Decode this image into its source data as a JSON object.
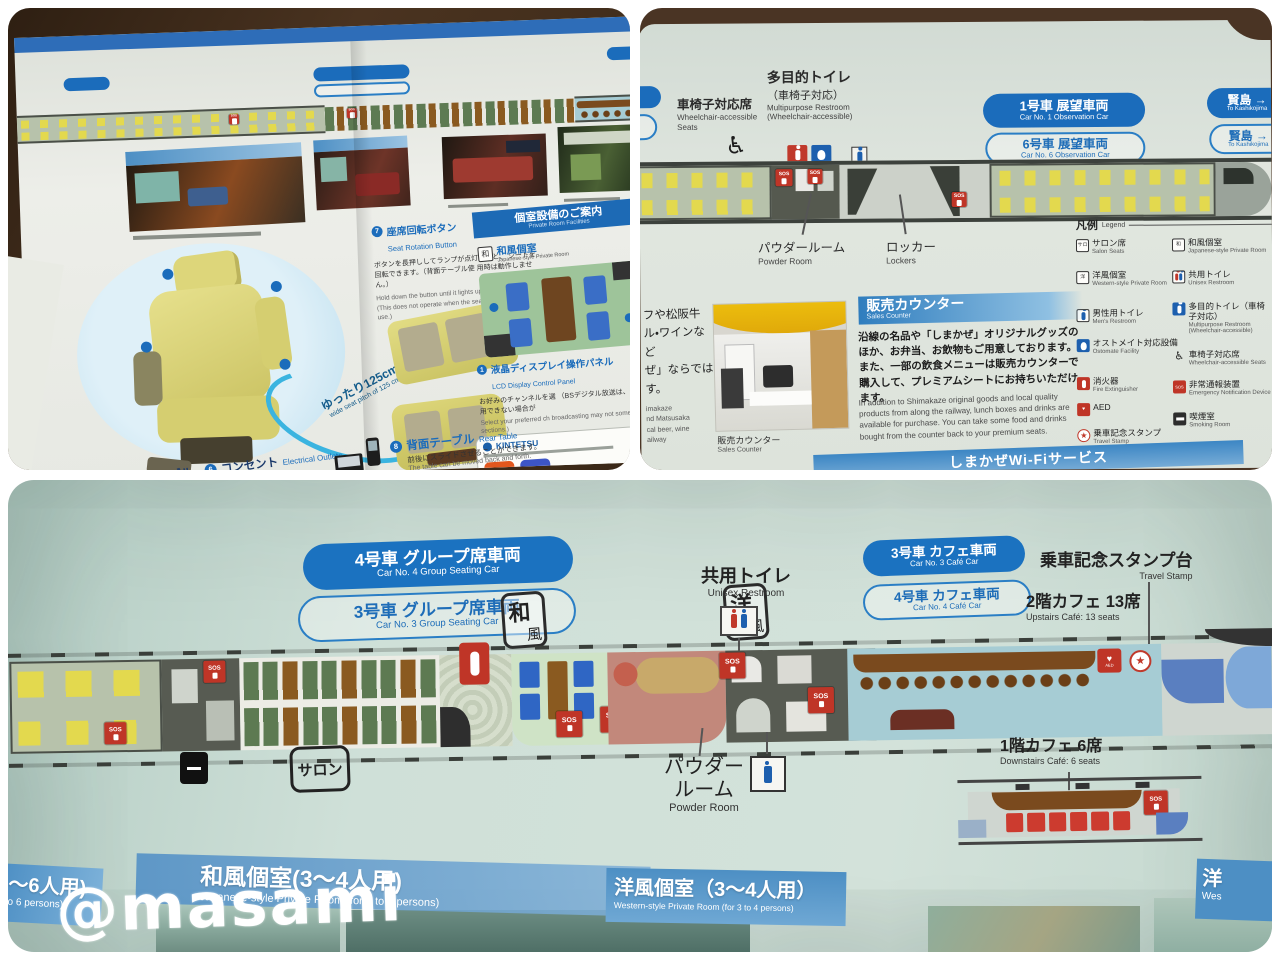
{
  "watermark": "@masami",
  "icons": {
    "sos": "SOS",
    "wheelchair": "♿",
    "star": "★",
    "heart": "♥",
    "aed": "AED",
    "salon_box": "サロ",
    "wa": "和",
    "yo": "洋"
  },
  "panel1": {
    "seat_rotation": {
      "num": "7",
      "jp": "座席回転ボタン",
      "en": "Seat Rotation Button",
      "body_jp": [
        "ボタンを長押ししてランプが点灯すると、",
        "シートを回転できます。（背面テーブル使",
        "用時は動作しません。）"
      ],
      "body_en": [
        "Hold down the button until it lights up to",
        "rotate the seat. (This does not operate",
        "when the seatback table is in use.)"
      ]
    },
    "private_rooms": {
      "jp": "個室設備のご案内",
      "en": "Private Room Facilities"
    },
    "japanese_room": {
      "jp": "和風個室",
      "en": "Japanese-style Private Room"
    },
    "lcd": {
      "num": "1",
      "jp": "液晶ディスプレイ操作パネル",
      "en": "LCD Display Control Panel",
      "body_jp": [
        "お好みのチャンネルを選",
        "（BSデジタル放送は、一",
        "ご利用できない場合が"
      ],
      "body_en": [
        "Select your preferred ch",
        "broadcasting may not",
        "some sections.)"
      ]
    },
    "kintetsu": "KINTETSU",
    "seat_pitch": {
      "jp": "ゆったり125cm",
      "en": "wide seat pitch of 125 cm"
    },
    "inarm": {
      "num": "5",
      "jp": "インアームテーブル",
      "en": "In-armrest Table"
    },
    "outlets": {
      "num": "6",
      "jp": "コンセント",
      "en": "Electrical Outlets",
      "spec": "AC100V MAX 0.6A"
    },
    "rear_table": {
      "num": "8",
      "jp": "背面テーブル",
      "en": "Rear Table",
      "body_jp": "前後にスライドさせることができます。",
      "body_en": "The table can be moved back and forth."
    }
  },
  "panel2": {
    "wheelchair_seats": {
      "jp": "車椅子対応席",
      "en": "Wheelchair-accessible Seats"
    },
    "multipurpose": {
      "jp": "多目的トイレ",
      "jp2": "（車椅子対応）",
      "en": "Multipurpose Restroom",
      "en2": "(Wheelchair-accessible)"
    },
    "car1": {
      "jp": "1号車 展望車両",
      "en": "Car No. 1 Observation Car"
    },
    "car6": {
      "jp": "6号車 展望車両",
      "en": "Car No. 6 Observation Car"
    },
    "kashikojima": {
      "jp": "賢島 →",
      "en": "To Kashikojima"
    },
    "powder": {
      "jp": "パウダールーム",
      "en": "Powder Room"
    },
    "lockers": {
      "jp": "ロッカー",
      "en": "Lockers"
    },
    "legend": {
      "title_jp": "凡例",
      "title_en": "Legend",
      "col1": [
        {
          "jp": "サロン席",
          "en": "Salon Seats"
        },
        {
          "jp": "洋風個室",
          "en": "Western-style Private Room"
        },
        {
          "jp": "男性用トイレ",
          "en": "Men's Restroom"
        },
        {
          "jp": "オストメイト対応設備",
          "en": "Ostomate Facility"
        },
        {
          "jp": "消火器",
          "en": "Fire Extinguisher"
        },
        {
          "jp": "AED",
          "en": ""
        },
        {
          "jp": "乗車記念スタンプ",
          "en": "Travel Stamp"
        }
      ],
      "col2": [
        {
          "jp": "和風個室",
          "en": "Japanese-style Private Room"
        },
        {
          "jp": "共用トイレ",
          "en": "Unisex Restroom"
        },
        {
          "jp": "多目的トイレ（車椅子対応）",
          "en": "Multipurpose Restroom (Wheelchair-accessible)"
        },
        {
          "jp": "車椅子対応席",
          "en": "Wheelchair-accessible Seats"
        },
        {
          "jp": "非常通報装置",
          "en": "Emergency Notification Device"
        },
        {
          "jp": "喫煙室",
          "en": "Smoking Room"
        }
      ]
    },
    "sales": {
      "title_jp": "販売カウンター",
      "title_en": "Sales Counter",
      "body_jp": "沿線の名品や「しまかぜ」オリジナルグッズのほか、お弁当、お飲物もご用意しております。また、一部の飲食メニューは販売カウンターで購入して、プレミアムシートにお持ちいただけます。",
      "body_en": "In addition to Shimakaze original goods and local quality products from along the railway, lunch boxes and drinks are available for purchase. You can take some food and drinks bought from the counter back to your premium seats.",
      "caption_jp": "販売カウンター",
      "caption_en": "Sales Counter",
      "fragment_jp": [
        "フや松阪牛",
        "ル・ワインなど",
        "ぜ」ならでは",
        "す。"
      ],
      "fragment_en": [
        "imakaze",
        "nd Matsusaka",
        "cal beer, wine",
        "ailway"
      ]
    },
    "wifi": "しまかぜWi-Fiサービス"
  },
  "panel3": {
    "car4_group": {
      "jp": "4号車  グループ席車両",
      "en": "Car No. 4 Group Seating Car"
    },
    "car3_group": {
      "jp": "3号車  グループ席車両",
      "en": "Car No. 3 Group Seating Car"
    },
    "unisex": {
      "jp": "共用トイレ",
      "en": "Unisex Restroom"
    },
    "car3_cafe": {
      "jp": "3号車  カフェ車両",
      "en": "Car No. 3 Café Car"
    },
    "car4_cafe": {
      "jp": "4号車  カフェ車両",
      "en": "Car No. 4 Café Car"
    },
    "stamp": {
      "jp": "乗車記念スタンプ台",
      "en": "Travel Stamp"
    },
    "upstairs": {
      "jp": "2階カフェ  13席",
      "en": "Upstairs Café: 13 seats"
    },
    "downstairs": {
      "jp": "1階カフェ  6席",
      "en": "Downstairs Café: 6 seats"
    },
    "powder": {
      "jp1": "パウダー",
      "jp2": "ルーム",
      "en": "Powder Room"
    },
    "salon": "サロン",
    "banner_left": {
      "jp": "～6人用)",
      "en": "o 6 persons)"
    },
    "banner_wa": {
      "jp": "和風個室(3～4人用)",
      "en": "Japanese-style Private Room (for 3 to 4 persons)"
    },
    "banner_yo": {
      "jp": "洋風個室（3～4人用）",
      "en": "Western-style Private Room (for 3 to 4 persons)"
    },
    "banner_right": {
      "jp": "洋",
      "en": "Wes"
    }
  }
}
